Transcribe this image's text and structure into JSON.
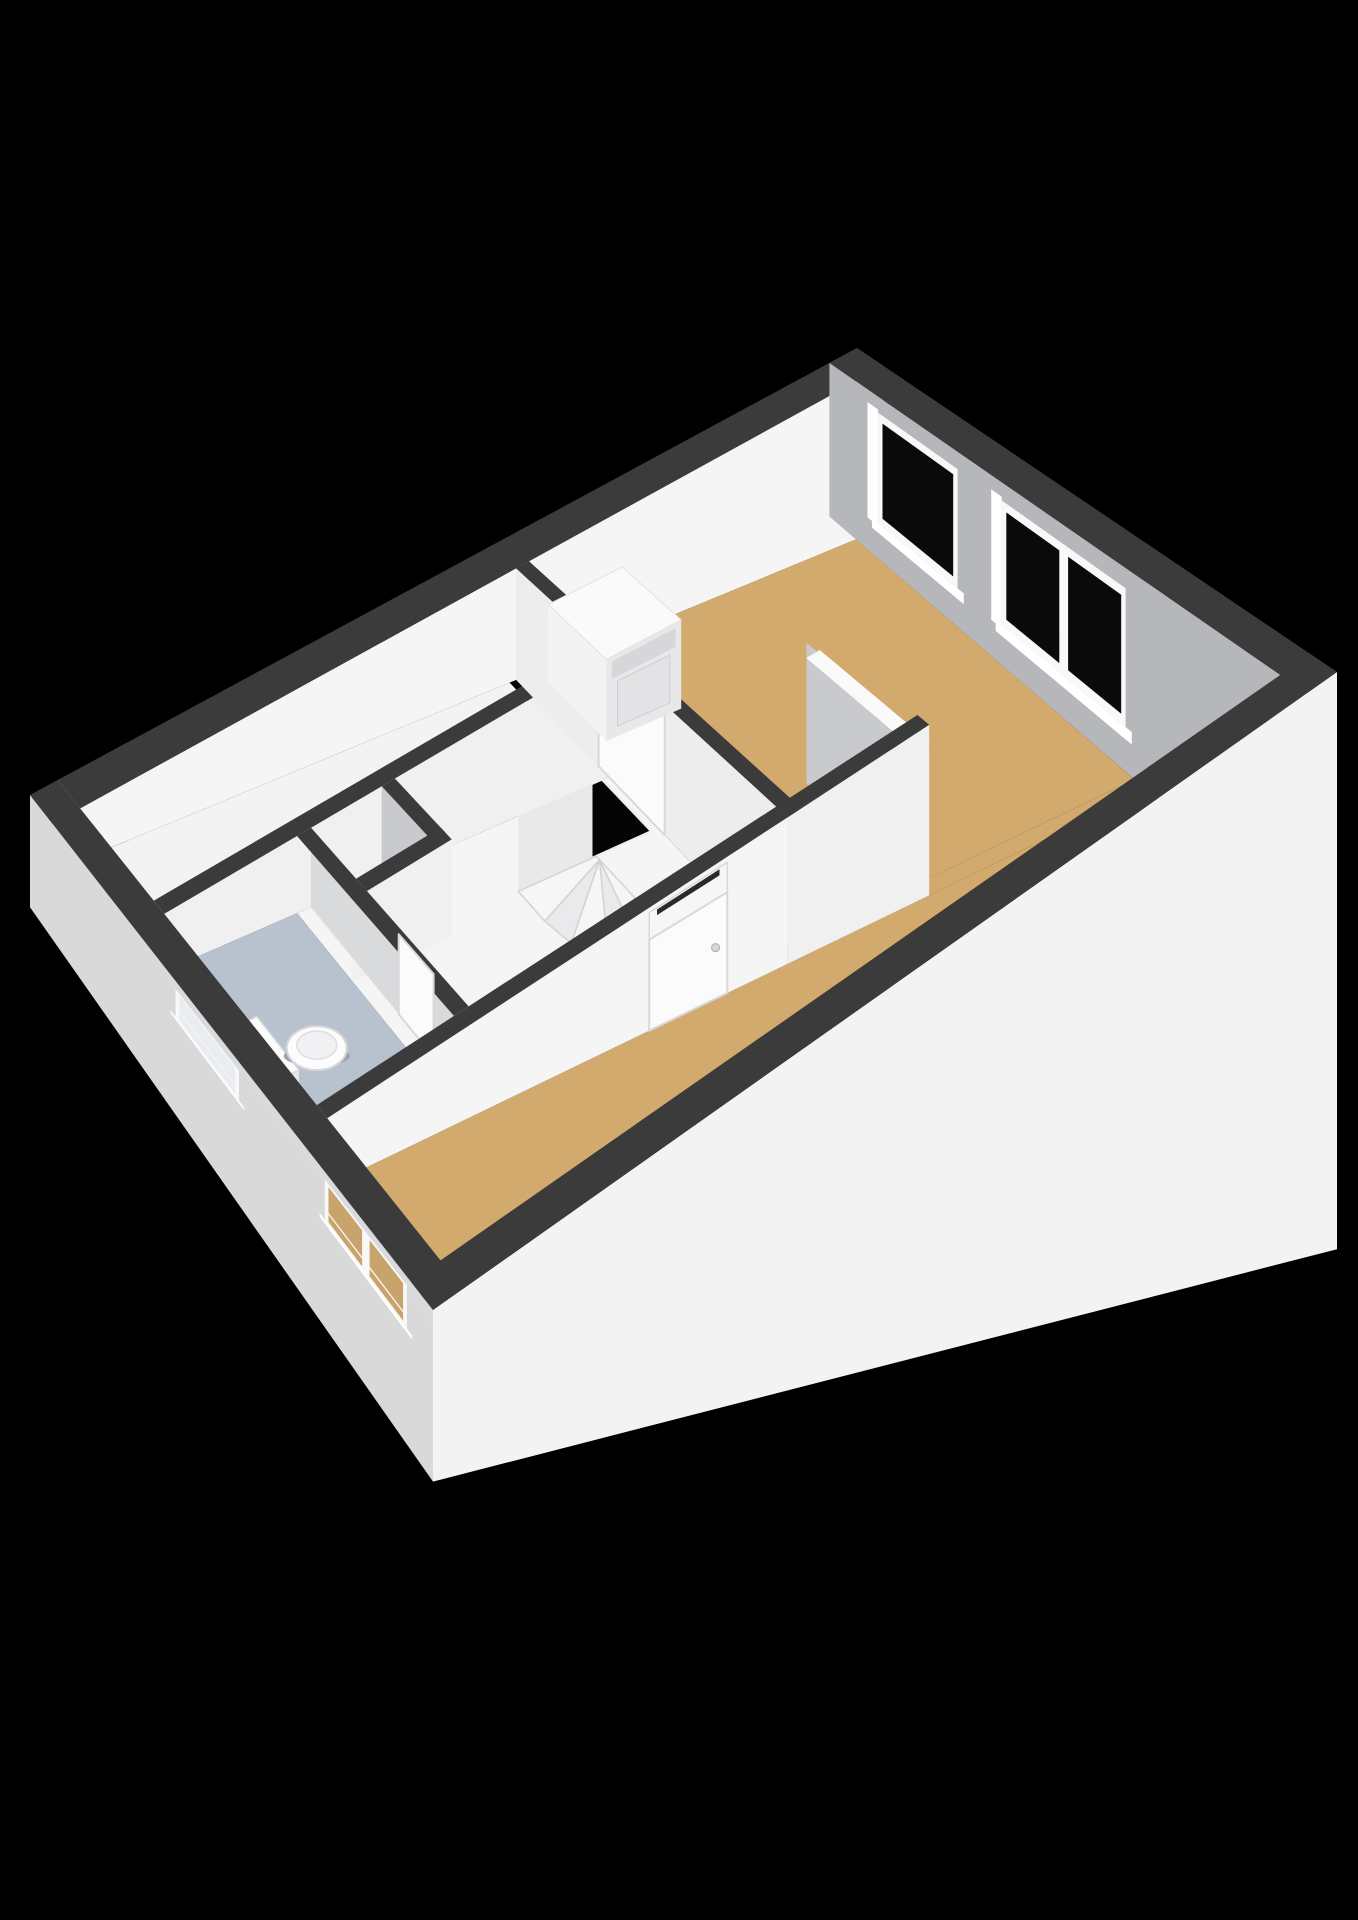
{
  "meta": {
    "title": "3D floor plan render — ground floor",
    "type": "3d-floorplan-view"
  },
  "scene": {
    "canvas": {
      "width": 1358,
      "height": 1920,
      "background": "#000000"
    },
    "plan": {
      "length": 9.0,
      "width": 5.4,
      "corners": {
        "west": [
          30,
          795
        ],
        "north": [
          857,
          348
        ],
        "south": [
          433,
          1310
        ],
        "east": [
          1337,
          672
        ]
      }
    },
    "heights": {
      "base": 55,
      "uGain": 130,
      "vBase": 0.85,
      "vGain": 0.45,
      "exteriorScale": 2.4
    },
    "palette": {
      "wallTop": "#3b3b3c",
      "wallTopLight": "#fafafa",
      "faceBrightWhite": "#f5f5f6",
      "faceWhite": "#f0f0f1",
      "faceSoftWhite": "#ededee",
      "faceGrayNE": "#b6b7ba",
      "faceGrayMid": "#c9cacd",
      "faceGrayLt": "#d9dadc",
      "extSW": "#d9d9da",
      "extSE": "#f3f3f4",
      "floorTan": "#d3aa6e",
      "floorWhite": "#f3f3f4",
      "floorHall": "#f5f5f6",
      "floorCloset": "#ededee",
      "floorToilet": "#b8c2cf",
      "glassDark": "#0a0a0b",
      "glassPale": "#e9ecf0",
      "glassTan": "#c9a36c",
      "frame": "#f8f8f9",
      "sill": "#ffffff",
      "voidBlack": "#050505",
      "voidRim": "#efefef",
      "tread": "#f6f6f7",
      "treadAlt": "#eaeaec",
      "treadEdge": "#d2d3d5",
      "stairBoxTop": "#f7f7f8",
      "stairBoxFace": "#e9e9ea",
      "stepLine": "#d8d8da",
      "doorLeaf": "#fbfbfc",
      "doorFrame": "#d8d8da",
      "transom": "#f6f6f7",
      "transomSlot": "#2a2a2b",
      "applianceTop": "#fafafb",
      "applianceSide": "#f3f3f4",
      "applianceFront": "#e8e8ea",
      "appliancePanel": "#d7d7d9",
      "applianceDoor": "#e3e3e5",
      "porcelain": "#fcfcfd",
      "porcelainShade": "#e7e7e9",
      "porcelainEdge": "#d6d6d8"
    },
    "floors": [
      {
        "name": "floor-kitchen",
        "rect": [
          0.3,
          0.3,
          4.95,
          1.28
        ],
        "color": "floorWhite",
        "nearFlat": false
      },
      {
        "name": "floor-hall",
        "rect": [
          1.71,
          1.42,
          5.02,
          3.45
        ],
        "color": "floorHall",
        "nearFlat": false
      },
      {
        "name": "floor-closet",
        "rect": [
          1.85,
          1.42,
          2.61,
          2.0
        ],
        "color": "floorCloset",
        "nearFlat": false
      },
      {
        "name": "floor-toilet",
        "rect": [
          0.3,
          1.42,
          1.71,
          3.45
        ],
        "color": "floorToilet",
        "nearFlat": false
      },
      {
        "name": "floor-bedroom",
        "rect": [
          5.16,
          0.3,
          8.7,
          3.45
        ],
        "color": "floorTan",
        "nearFlat": false
      },
      {
        "name": "floor-passage",
        "rect": [
          6.47,
          3.45,
          8.7,
          3.59
        ],
        "color": "floorTan",
        "nearFlat": false
      },
      {
        "name": "floor-living",
        "rect": [
          0.3,
          3.59,
          8.7,
          5.1
        ],
        "color": "floorTan",
        "nearFlat": true
      }
    ],
    "walls": {
      "far": [
        {
          "name": "wall-nw",
          "axis": "x",
          "pos": 0.15,
          "half": 0.15,
          "span": [
            0,
            9
          ],
          "top": "wallTop",
          "faces": [
            {
              "side": "S",
              "color": "faceBrightWhite"
            }
          ]
        },
        {
          "name": "wall-ne",
          "axis": "y",
          "pos": 8.85,
          "half": 0.15,
          "span": [
            0,
            5.4
          ],
          "top": "wallTop",
          "faces": [
            {
              "side": "W",
              "color": "faceGrayNE"
            }
          ],
          "windows": [
            {
              "name": "window-ne-single",
              "side": "W",
              "from": 0.55,
              "to": 1.45,
              "panes": 1,
              "frameK": [
                0.1,
                0.78
              ],
              "glass": "glassDark",
              "reveal": true,
              "sillBar": true
            },
            {
              "name": "window-ne-double",
              "side": "W",
              "from": 1.95,
              "to": 3.35,
              "panes": 2,
              "frameK": [
                0.1,
                0.78
              ],
              "glass": "glassDark",
              "reveal": true,
              "sillBar": true
            }
          ]
        }
      ],
      "mid": [
        {
          "name": "wall-kitchen-hall",
          "axis": "x",
          "pos": 1.35,
          "half": 0.07,
          "span": [
            0.3,
            5.02
          ],
          "top": "wallTop",
          "faces": [
            {
              "side": "S",
              "color": "faceWhite"
            }
          ]
        },
        {
          "name": "wall-closet-right",
          "axis": "y",
          "pos": 2.68,
          "half": 0.07,
          "span": [
            1.42,
            2.07
          ],
          "top": "wallTop",
          "faces": [
            {
              "side": "W",
              "color": "faceGrayMid"
            }
          ]
        },
        {
          "name": "wall-closet-bottom",
          "axis": "x",
          "pos": 2.07,
          "half": 0.07,
          "span": [
            1.71,
            2.75
          ],
          "top": "wallTop",
          "faces": [
            {
              "side": "S",
              "color": "faceWhite"
            }
          ]
        },
        {
          "name": "wall-toilet-right",
          "axis": "y",
          "pos": 1.785,
          "half": 0.075,
          "span": [
            1.42,
            3.45
          ],
          "top": "wallTop",
          "faces": [
            {
              "side": "E",
              "color": "faceGrayLt"
            }
          ],
          "door": {
            "name": "door-toilet",
            "side": "E",
            "from": 2.55,
            "to": 3.0
          }
        },
        {
          "name": "wall-hall-bedroom",
          "axis": "y",
          "pos": 5.09,
          "half": 0.07,
          "span": [
            0.3,
            3.59
          ],
          "top": "wallTop",
          "faces": [
            {
              "side": "W",
              "color": "faceSoftWhite"
            }
          ],
          "door": {
            "name": "door-bedroom",
            "side": "W",
            "from": 1.3,
            "to": 2.1
          }
        },
        {
          "name": "wall-partial",
          "axis": "y",
          "pos": 6.4,
          "half": 0.07,
          "span": [
            2.3,
            3.59
          ],
          "top": "wallTopLight",
          "topK": 0.1,
          "hScale": 0.92,
          "faces": [
            {
              "side": "W",
              "color": "faceGrayMid"
            }
          ]
        },
        {
          "name": "wall-bedroom-living",
          "axis": "x",
          "pos": 3.52,
          "half": 0.07,
          "span": [
            5.02,
            6.47
          ],
          "top": "wallTop",
          "faces": [
            {
              "side": "S",
              "color": "faceWhite"
            }
          ]
        },
        {
          "name": "wall-hall-living",
          "axis": "x",
          "pos": 3.52,
          "half": 0.07,
          "span": [
            0.3,
            5.02
          ],
          "top": "wallTop",
          "faces": [
            {
              "side": "S",
              "color": "faceBrightWhite"
            }
          ],
          "door": {
            "name": "door-front",
            "side": "S",
            "from": 3.6,
            "to": 4.4,
            "transom": true,
            "handle": true
          }
        }
      ],
      "near": [
        {
          "name": "wall-sw",
          "axis": "y",
          "pos": 0.15,
          "half": 0.15,
          "span": [
            0,
            5.4
          ],
          "top": "wallTop",
          "faces": [
            {
              "side": "Wext",
              "color": "extSW"
            },
            {
              "side": "E",
              "color": "faceGrayLt"
            }
          ],
          "windows": [
            {
              "name": "window-toilet",
              "side": "Wext",
              "from": 1.95,
              "to": 2.8,
              "panes": 1,
              "frameK": [
                0.06,
                0.27
              ],
              "glass": "glassPale",
              "hBar": 0.62,
              "sillBar": true
            },
            {
              "name": "window-living",
              "side": "Wext",
              "from": 3.95,
              "to": 5.05,
              "panes": 2,
              "frameK": [
                0.05,
                0.31
              ],
              "glass": "glassTan",
              "hBar": 0.7,
              "sillBar": true
            }
          ]
        },
        {
          "name": "wall-se",
          "axis": "x",
          "pos": 5.25,
          "half": 0.15,
          "span": [
            0,
            9
          ],
          "top": "wallTop",
          "faces": [
            {
              "side": "Sext",
              "color": "extSE"
            }
          ]
        }
      ]
    },
    "stairs": {
      "name": "staircase-winder",
      "void": {
        "name": "stairwell-void",
        "rect": [
          4.33,
          1.42,
          4.95,
          2.02
        ]
      },
      "box": {
        "name": "stair-upper-flight",
        "rect": [
          3.55,
          1.42,
          4.33,
          2.02
        ],
        "topK": 0.18,
        "stepLinesY": [
          1.57,
          1.72,
          1.87
        ]
      },
      "treads": [
        {
          "pts": [
            [
              4.37,
              2.06
            ],
            [
              4.37,
              2.02
            ],
            [
              3.55,
              2.02
            ],
            [
              3.55,
              2.35
            ]
          ]
        },
        {
          "pts": [
            [
              4.37,
              2.06
            ],
            [
              3.55,
              2.35
            ],
            [
              3.6,
              2.62
            ]
          ]
        },
        {
          "pts": [
            [
              4.37,
              2.06
            ],
            [
              3.6,
              2.62
            ],
            [
              3.81,
              2.83
            ]
          ]
        },
        {
          "pts": [
            [
              4.37,
              2.06
            ],
            [
              3.81,
              2.83
            ],
            [
              4.08,
              2.92
            ]
          ]
        },
        {
          "pts": [
            [
              4.37,
              2.06
            ],
            [
              4.08,
              2.92
            ],
            [
              4.37,
              2.92
            ]
          ]
        }
      ]
    },
    "fixtures": {
      "washer": {
        "name": "washing-machine",
        "rect": [
          5.26,
          0.42,
          6.06,
          1.12
        ],
        "topK": 0.34,
        "panelK": [
          0.38,
          0.52
        ],
        "doorK": [
          0.56,
          0.92
        ]
      },
      "toilet": {
        "name": "toilet-fixture",
        "tank": [
          0.34,
          2.32,
          0.56,
          2.88
        ],
        "tankTopK": 0.5,
        "bowlCenter": [
          0.95,
          2.62
        ],
        "bowlK": 0.82,
        "bowlRx": 30,
        "bowlRy": 22,
        "seatRx": 20,
        "seatRy": 14
      }
    }
  }
}
